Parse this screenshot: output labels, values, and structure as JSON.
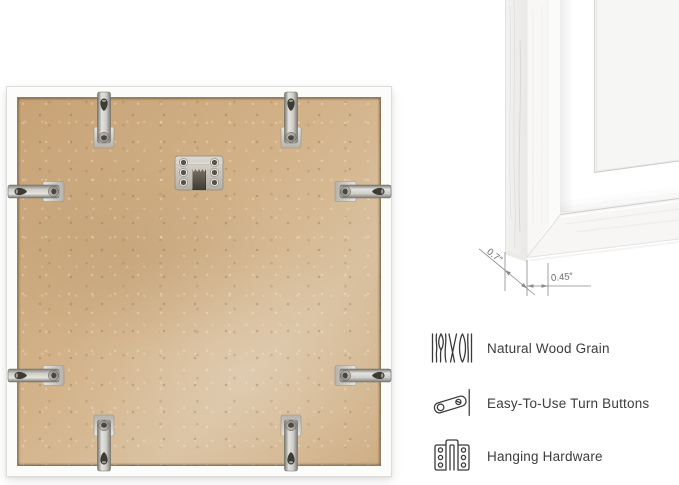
{
  "closeup": {
    "depth_label": "0.7″",
    "width_label": "0.45″"
  },
  "back_panel": {
    "turn_button_count": 8,
    "hanging_hardware_count": 1
  },
  "features": {
    "items": [
      {
        "icon": "wood-grain-icon",
        "label": "Natural Wood Grain"
      },
      {
        "icon": "turn-button-icon",
        "label": "Easy-To-Use Turn Buttons"
      },
      {
        "icon": "hanging-hardware-icon",
        "label": "Hanging Hardware"
      }
    ]
  },
  "colors": {
    "backing": "#cfab80",
    "frame_white": "#fcfcfb",
    "hardware_metal": "#cfcec9",
    "text": "#3c3c3c",
    "dimension_lines": "#8a8a8a"
  }
}
